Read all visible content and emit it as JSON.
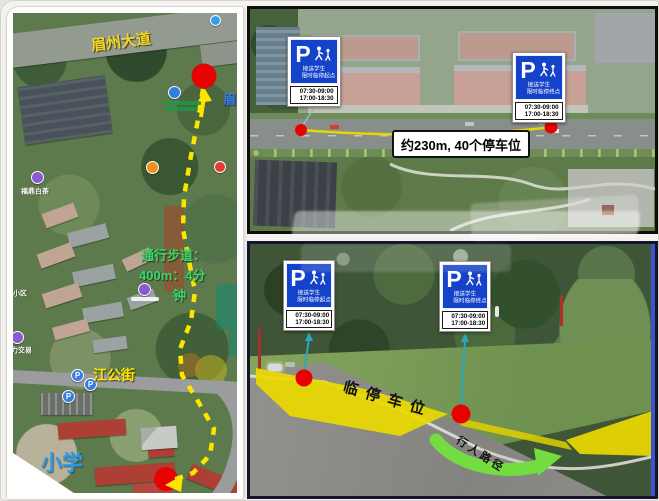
{
  "signs": {
    "p": "P",
    "line1": "接送学生",
    "line2_start": "限时临停起点",
    "line2_end": "限时临停终点",
    "time1": "07:30-09:00",
    "time2": "17:00-18:30"
  },
  "left_map": {
    "avenue": "眉州大道",
    "avenue_partial": "眉州",
    "street": "江公街",
    "school": "小学",
    "note_line1": "通行步道：",
    "note_line2": "400m：4分",
    "note_line3": "钟",
    "poi_tea": "福鼎白茶",
    "poi_trade": "力交易",
    "poi_community": "小区",
    "p_marker": "P"
  },
  "top_right": {
    "distance_label": "约230m, 40个停车位"
  },
  "bottom_right": {
    "parking_area": "临停车位",
    "pedestrian_path": "行人路径"
  },
  "colors": {
    "sign_blue": "#1442c8",
    "dot_red": "#e60000",
    "route_yellow": "#ffe400",
    "arrow_green": "#72dc41",
    "area_yellow": "#ead900"
  }
}
